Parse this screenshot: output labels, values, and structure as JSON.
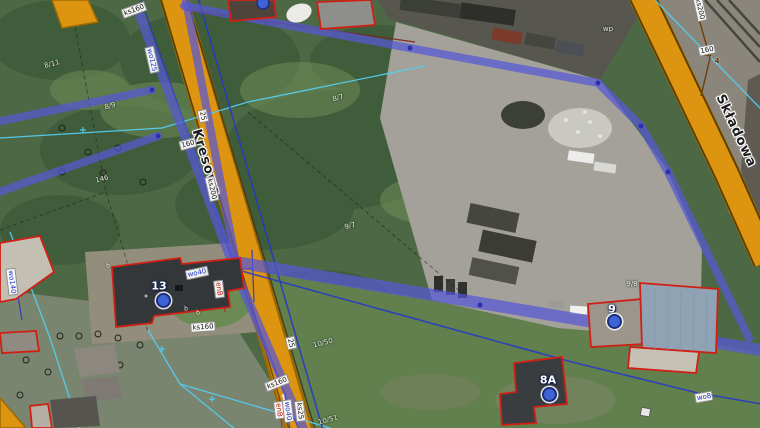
{
  "map": {
    "type": "aerial-cadastral-map",
    "streets": {
      "kresowa": "Kresowa",
      "skladowa": "Składowa"
    },
    "address_points": [
      {
        "label": "13"
      },
      {
        "label": "9"
      },
      {
        "label": "8A"
      },
      {
        "label": ""
      }
    ],
    "utility_labels": {
      "ks160_topleft": "ks160",
      "wo125_kresowa": "wo125",
      "dn25_kresowa": "25",
      "dn160_kresowa": "160",
      "ks200_kresowa": "ks200",
      "ks200_skladowa": "ks200",
      "dn160_skladowa": "160",
      "gas_4": "4",
      "wo40_house13": "wo40",
      "enb_house13": "enB",
      "ks160_house13": "ks160",
      "wo140_left": "wo140",
      "dn25_south": "25",
      "ks160_south": "ks160",
      "enb_south": "enB",
      "wo40_south": "wo40",
      "ks25_south": "ks25",
      "wo8_southeast": "wo8"
    },
    "parcel_labels": {
      "p8_11": "8/11",
      "p8_9": "8/9",
      "p146": "146",
      "p8_7": "8/7",
      "p9_7": "9/7",
      "p9_8": "9/8",
      "p10_50": "10/50",
      "p10_51": "10/51",
      "pwp": "wp"
    },
    "point_marks": {
      "b1": "b",
      "b2": "b",
      "b3": "b"
    },
    "colors": {
      "road": "#dd9411",
      "sewer_ks": "#5658d6",
      "water_wo": "#2438c8",
      "cadastral": "#54cdf0",
      "building_outline": "#d21f14",
      "electric_enb": "#b3281c",
      "gas": "#6e4312",
      "address_marker": "#3f63d6"
    }
  }
}
